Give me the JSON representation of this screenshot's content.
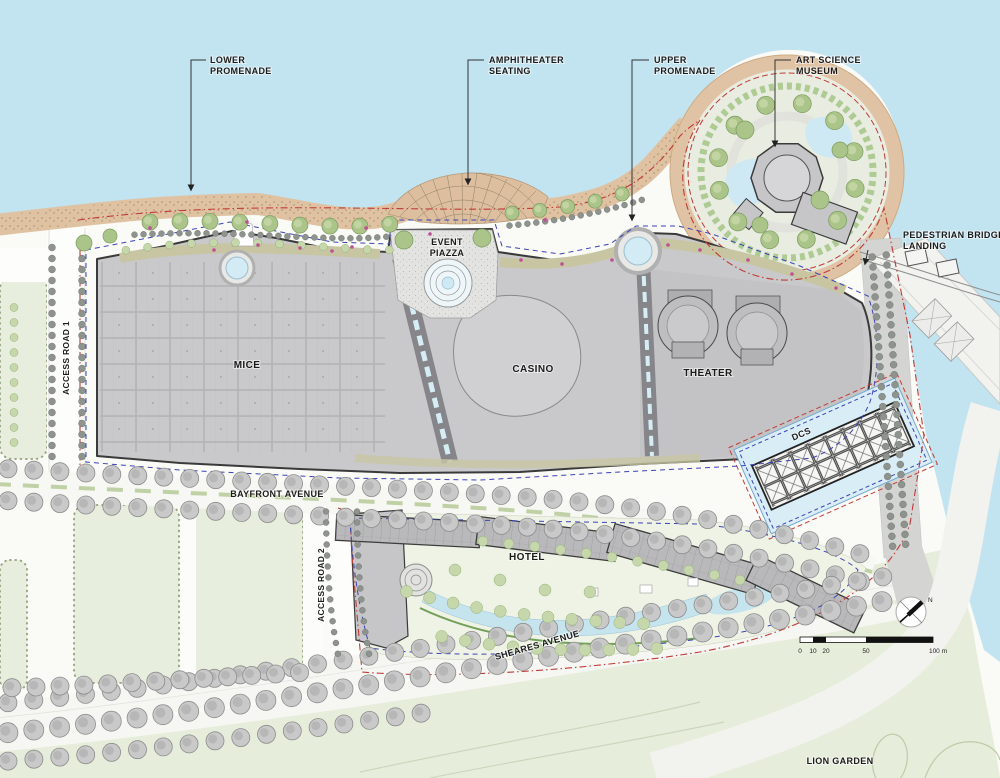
{
  "plan": {
    "callouts": {
      "lower_promenade": {
        "lines": [
          "LOWER",
          "PROMENADE"
        ]
      },
      "amphitheater_seating": {
        "lines": [
          "AMPHITHEATER",
          "SEATING"
        ]
      },
      "upper_promenade": {
        "lines": [
          "UPPER",
          "PROMENADE"
        ]
      },
      "art_science_museum": {
        "lines": [
          "ART SCIENCE",
          "MUSEUM"
        ]
      },
      "pedestrian_bridge_landing": {
        "lines": [
          "PEDESTRIAN BRIDGE",
          "LANDING"
        ]
      }
    },
    "areas": {
      "event_piazza": {
        "lines": [
          "EVENT",
          "PIAZZA"
        ]
      },
      "mice": "MICE",
      "casino": "CASINO",
      "theater": "THEATER",
      "hotel": "HOTEL",
      "dcs": "DCS",
      "lion_garden": "LION GARDEN"
    },
    "roads": {
      "access_road_1": "ACCESS ROAD 1",
      "access_road_2": "ACCESS ROAD 2",
      "bayfront_avenue": "BAYFRONT AVENUE",
      "sheares_avenue": "SHEARES AVENUE"
    },
    "scale_bar": {
      "ticks": [
        "0",
        "10",
        "20",
        "50",
        "100 m"
      ]
    },
    "compass": {
      "north_label": "N"
    },
    "colors": {
      "water": "#c2e3f0",
      "land": "#fafaf7",
      "green_field": "#e7eedd",
      "garden_green": "#e6eedb",
      "beach_tan": "#dfc2a2",
      "building_gray": "#c9c9cb",
      "building_outline": "#3a3a3a",
      "boundary_red": "#c03a36",
      "boundary_blue": "#3a43b5",
      "pool_blue": "#c5e4ee",
      "tree_green": "#aac489",
      "accent_pink": "#bf4f96"
    }
  }
}
